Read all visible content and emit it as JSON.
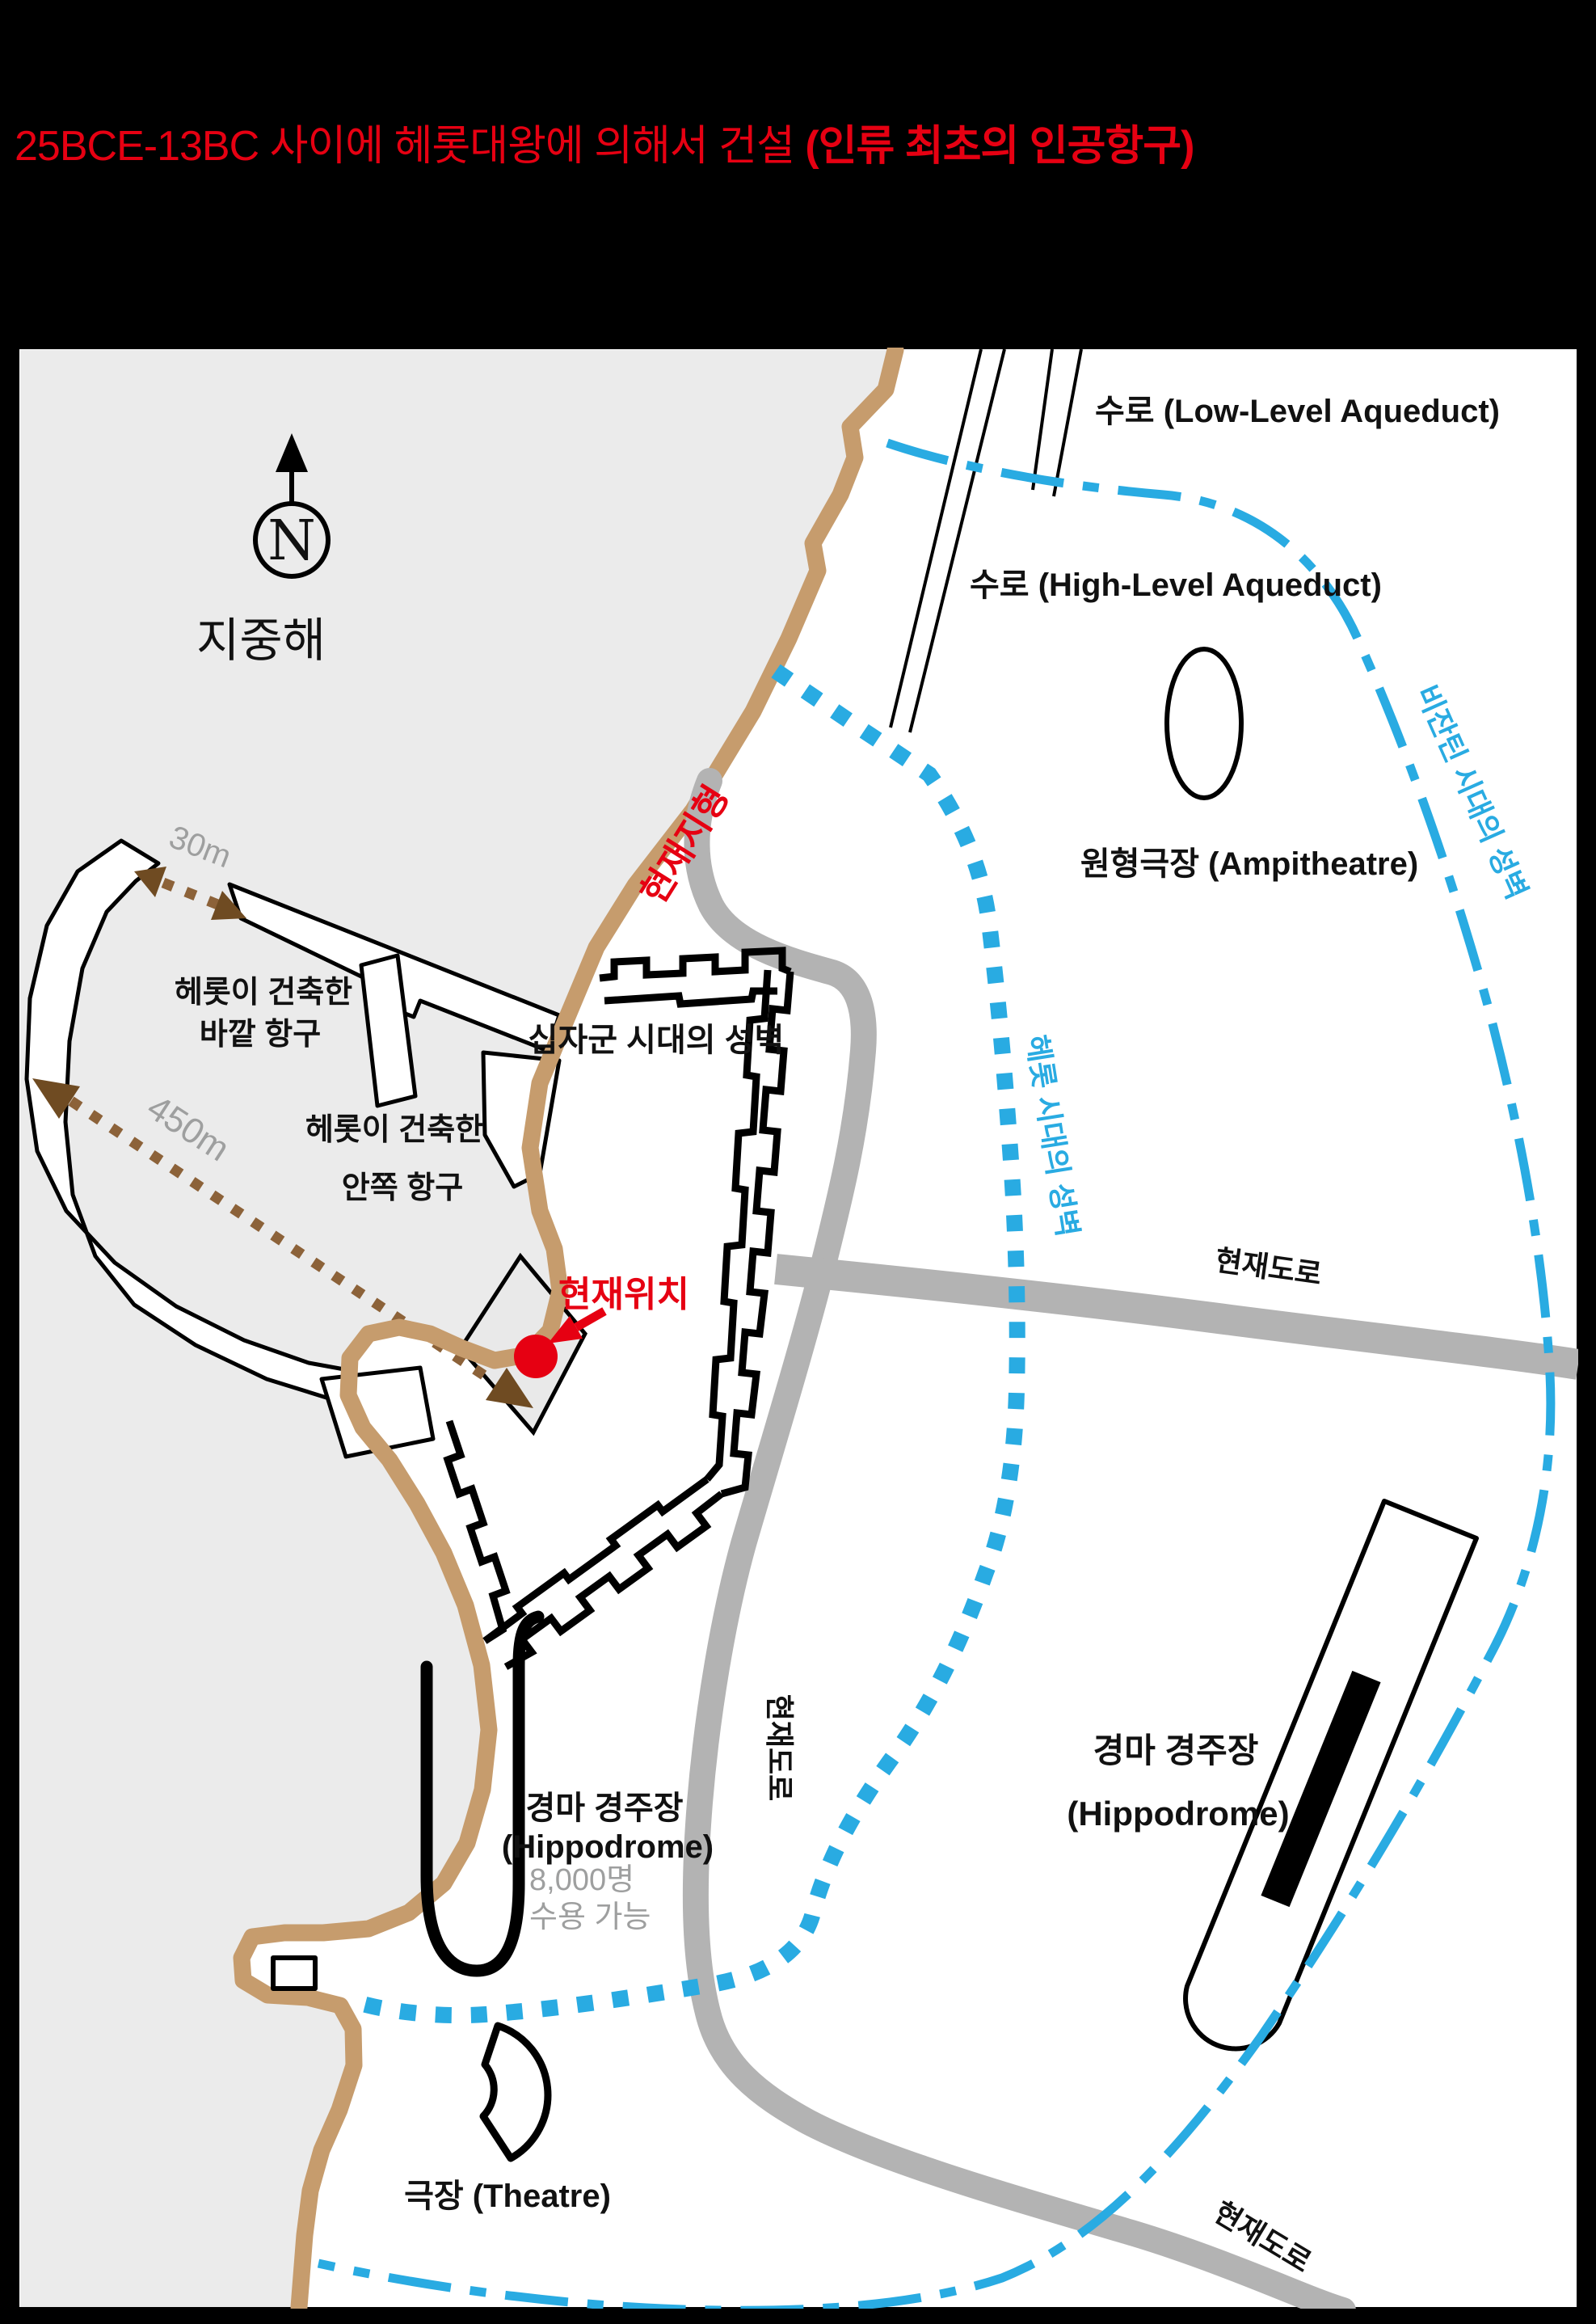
{
  "title": {
    "prefix": "25BCE-13BC 사이에 헤롯대왕에 의해서 건설 ",
    "highlight": "(인류 최초의 인공항구)"
  },
  "colors": {
    "accent_red": "#e60012",
    "wall_blue": "#29abe2",
    "coast_tan": "#c69c6d",
    "road_gray": "#b3b3b3",
    "sea_gray": "#ebebeb",
    "muted_gray": "#9e9f9f",
    "brown": "#8c6239",
    "dark_brown": "#6f4b22"
  },
  "compass": {
    "north_letter": "N"
  },
  "labels": {
    "sea": "지중해",
    "aqueduct_low": "수로 (Low-Level Aqueduct)",
    "aqueduct_high": "수로 (High-Level Aqueduct)",
    "amphitheatre": "원형극장 (Ampitheatre)",
    "byzantine_wall": "비잔틴 시대의 성벽",
    "herod_wall": "헤롯 시대의 성벽",
    "crusader_wall": "십자군 시대의 성벽",
    "current_terrain": "현재지형",
    "current_location": "현재위치",
    "current_road": "현재도로",
    "herod_built": "헤롯이 건축한",
    "outer_harbor": "바깥 항구",
    "inner_harbor": "안쪽 항구",
    "dist_450m": "450m",
    "dist_30m": "30m",
    "hippodrome_ko": "경마 경주장",
    "hippodrome_en": "(Hippodrome)",
    "capacity_line1": "8,000명",
    "capacity_line2": "수용 가능",
    "theatre": "극장 (Theatre)"
  }
}
